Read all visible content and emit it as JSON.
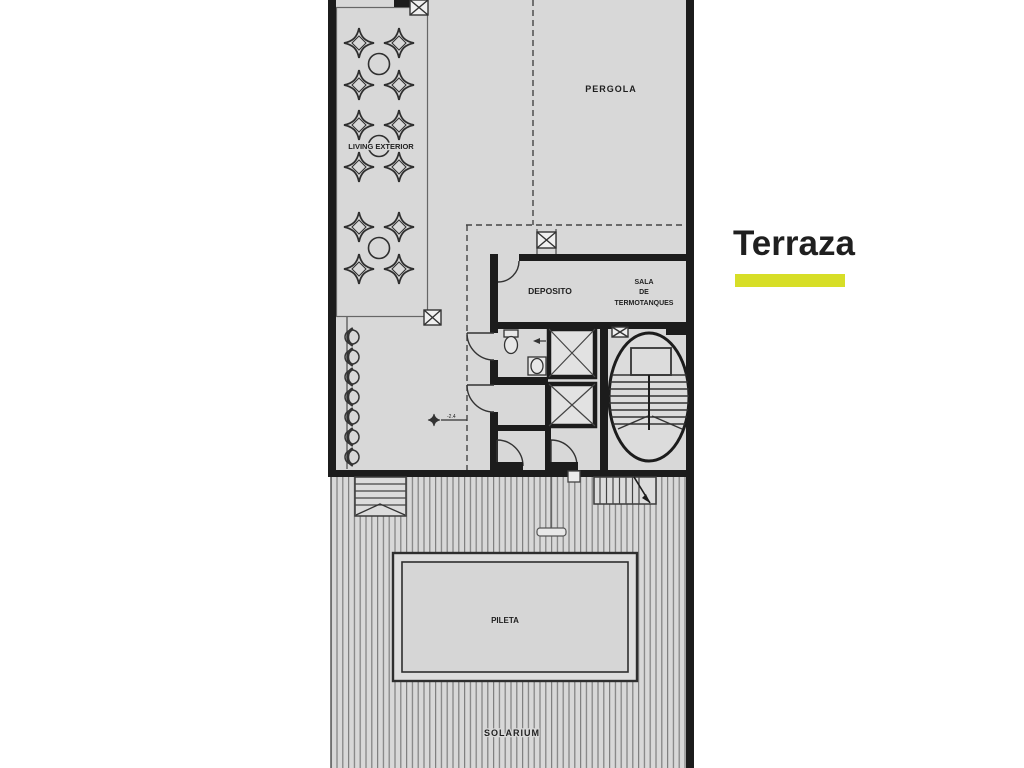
{
  "title": {
    "label": "Terraza",
    "accent_color": "#d7de27",
    "text_color": "#1d1d1d"
  },
  "plan": {
    "labels": {
      "pergola": "PERGOLA",
      "living_exterior": "LIVING EXTERIOR",
      "deposito": "DEPOSITO",
      "sala_de_termotanques": [
        "SALA",
        "DE",
        "TERMOTANQUES"
      ],
      "pileta": "PILETA",
      "solarium": "SOLARIUM",
      "level_mark": "-2.4"
    },
    "colors": {
      "floor": "#d8d8d8",
      "wall": "#1c1c1c",
      "line": "#4a4a4a",
      "deck_stripe": "#7f7f7f",
      "elevator_fill": "#e2e2e2"
    }
  }
}
